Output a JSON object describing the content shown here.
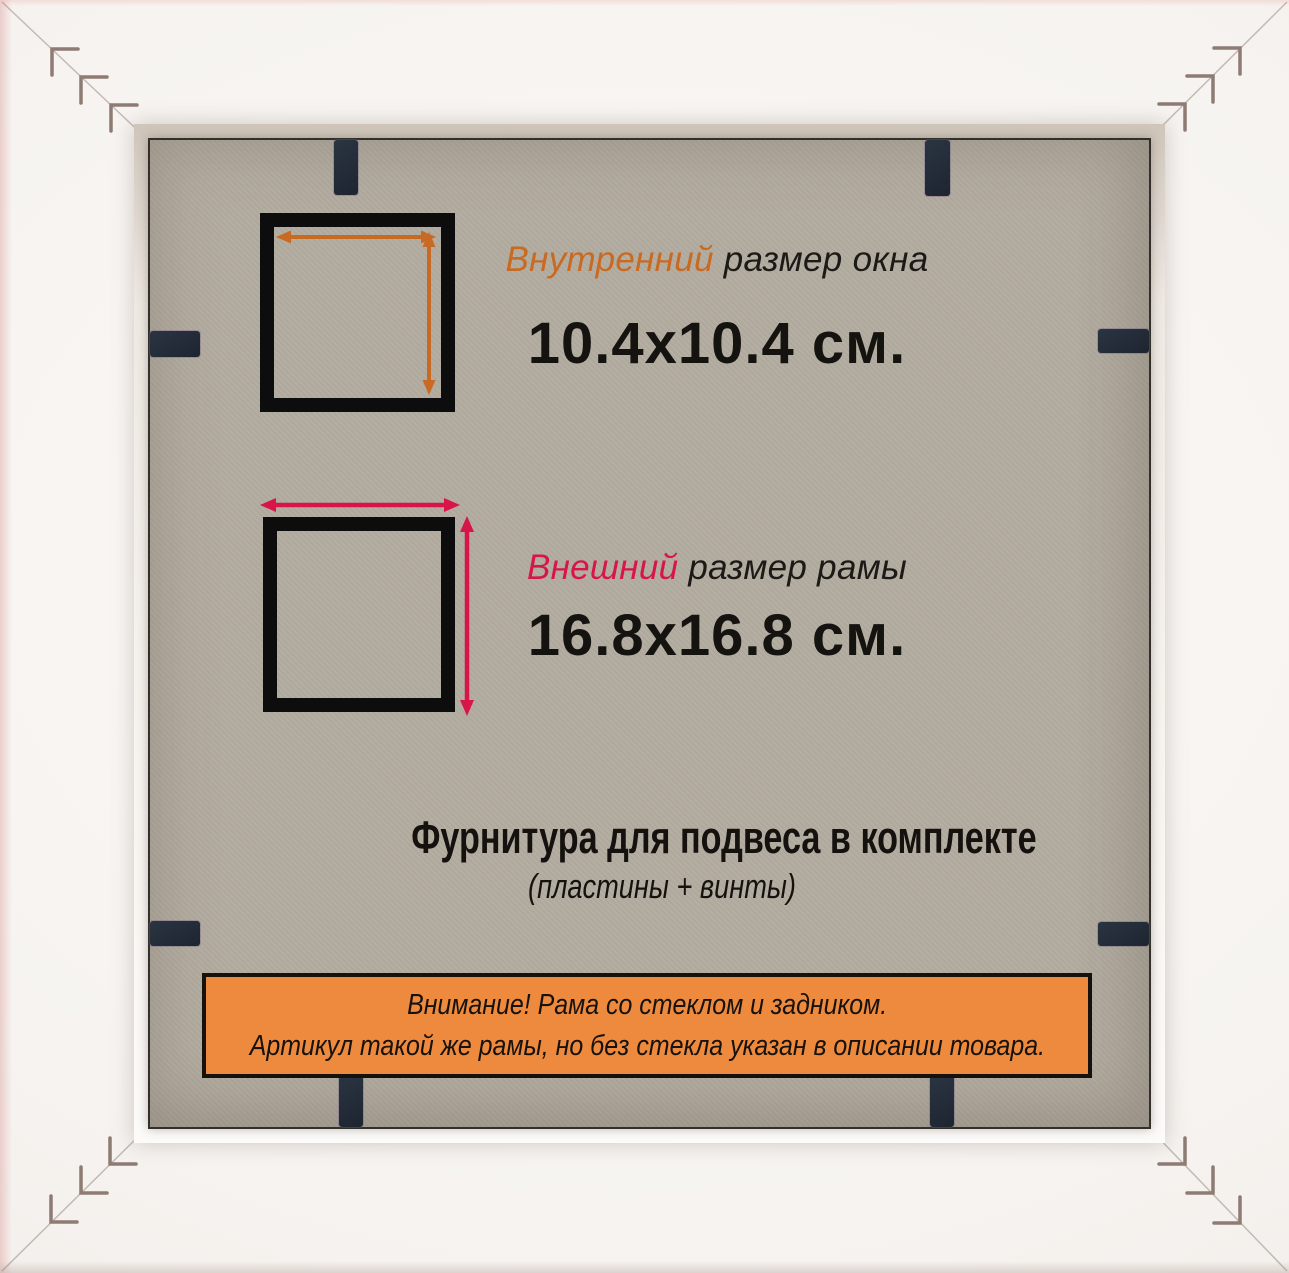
{
  "inner_size": {
    "label_accent": "Внутренний",
    "label_rest": "размер окна",
    "value": "10.4x10.4 см."
  },
  "outer_size": {
    "label_accent": "Внешний",
    "label_rest": "размер рамы",
    "value": "16.8x16.8 см."
  },
  "hardware": {
    "line1": "Фурнитура для подвеса в комплекте",
    "line2": "(пластины + винты)"
  },
  "notice": {
    "line1": "Внимание! Рама со стеклом и задником.",
    "line2": "Артикул такой же рамы, но без стекла указан в описании товара."
  },
  "colors": {
    "inner_accent": "#c96a22",
    "outer_accent": "#d81549",
    "notice_bg": "#ee8a3d",
    "backing": "#b3aca0",
    "clip_dark": "#232b38",
    "square_border": "#0d0d0d",
    "frame_white": "#f6f3f0"
  }
}
